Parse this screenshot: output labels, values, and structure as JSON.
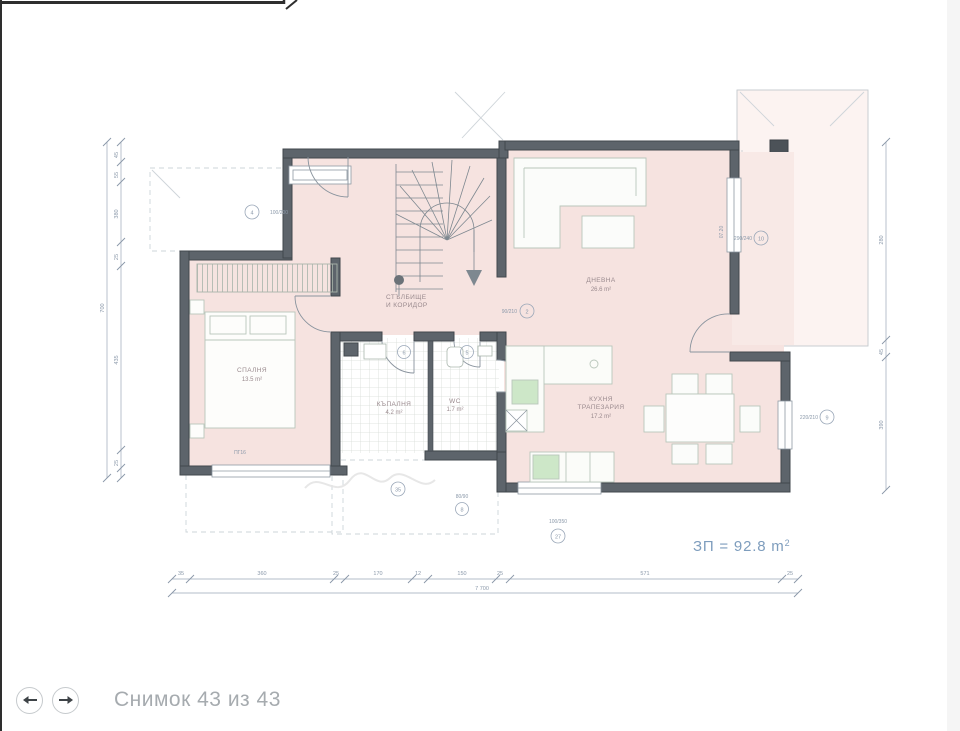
{
  "viewer": {
    "caption": "Снимок 43 из 43"
  },
  "plan": {
    "total_area": "ЗП = 92.8 m",
    "total_area_sup": "2",
    "rooms": {
      "bedroom": {
        "name": "СПАЛНЯ",
        "area": "13.5 m²"
      },
      "stairs": {
        "line1": "СТЪЛБИЩЕ",
        "line2": "И КОРИДОР"
      },
      "living": {
        "name": "ДНЕВНА",
        "area": "26.6 m²"
      },
      "kitchen": {
        "line1": "КУХНЯ",
        "line2": "ТРАПЕЗАРИЯ",
        "area": "17.2 m²"
      },
      "bath": {
        "name": "КЪПАЛНЯ",
        "area": "4.2 m²"
      },
      "wc": {
        "name": "WC",
        "area": "1.7 m²"
      }
    },
    "labels": {
      "front_door": "100/200",
      "passage": "90/210",
      "living_window": "290/240",
      "dining_window": "220/210",
      "kitchen_window": "100/350",
      "bath_window": "80/90",
      "flue": "07.20",
      "bedroom_floor": "ПГ16"
    },
    "tags": {
      "t1": "4",
      "t2": "2",
      "t3": "10",
      "t4": "9",
      "t5": "5",
      "t6": "6",
      "t7": "35",
      "t8": "8",
      "t9": "27"
    },
    "dims": {
      "bottom": [
        "35",
        "360",
        "25",
        "170",
        "12",
        "150",
        "25",
        "571",
        "25"
      ],
      "bottom_total": "7 700",
      "left": [
        "45",
        "55",
        "380",
        "25",
        "435",
        "25"
      ],
      "left_total": "700",
      "right": [
        "280",
        "45",
        "390"
      ]
    }
  }
}
